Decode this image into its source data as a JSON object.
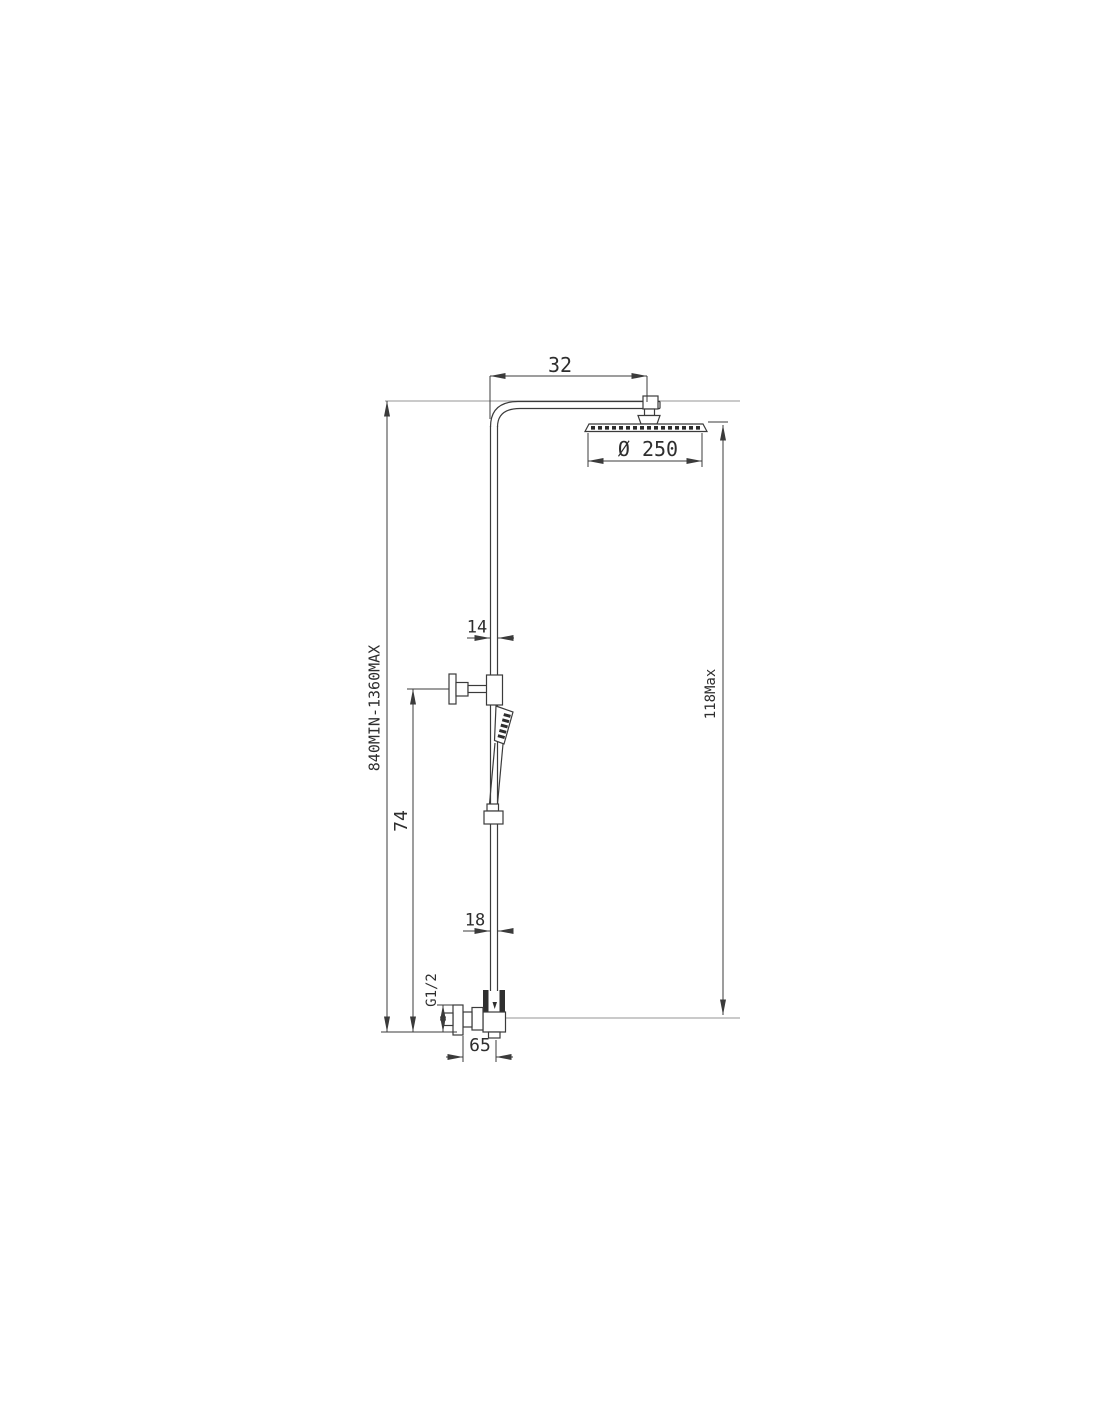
{
  "drawing": {
    "type": "shower-column-technical-dimension-drawing",
    "line_color": "#3b3b3b",
    "extension_line_color": "#ababab",
    "dimensions": {
      "arm_length": "32",
      "head_diameter": "Ø 250",
      "upper_pipe_diameter": "14",
      "height_range": "840MIN-1360MAX",
      "slide_bar_height": "74",
      "overall_height": "118Max",
      "lower_pipe_diameter": "18",
      "inlet_thread": "G1/2",
      "valve_offset": "65"
    }
  }
}
